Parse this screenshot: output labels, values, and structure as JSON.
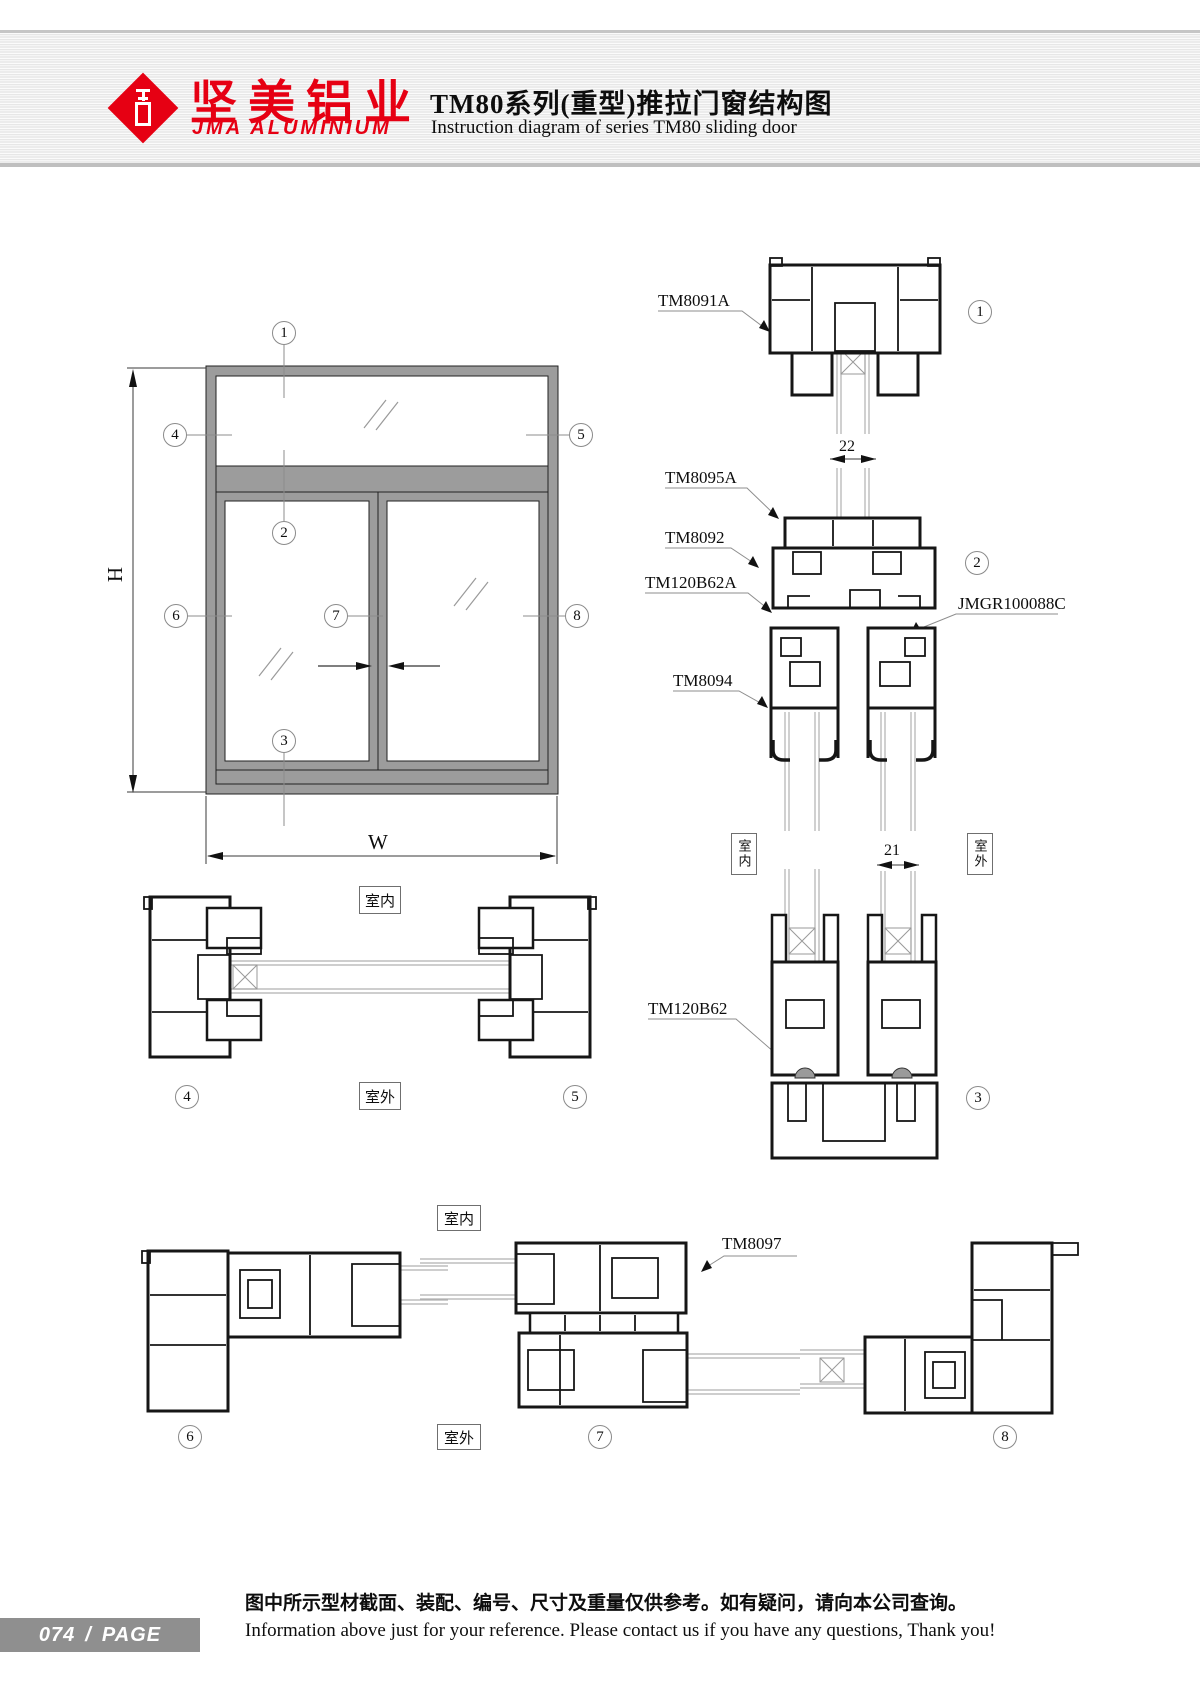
{
  "header": {
    "logo_cn": "坚美铝业",
    "logo_en": "JMA ALUMINIUM",
    "title_cn": "TM80系列(重型)推拉门窗结构图",
    "title_en": "Instruction diagram of series TM80 sliding door"
  },
  "labels": {
    "tm8091a": "TM8091A",
    "tm8095a": "TM8095A",
    "tm8092": "TM8092",
    "tm120b62a": "TM120B62A",
    "jmgr100088c": "JMGR100088C",
    "tm8094": "TM8094",
    "tm120b62": "TM120B62",
    "tm8097": "TM8097"
  },
  "dims": {
    "h": "H",
    "w": "W",
    "d22": "22",
    "d21": "21"
  },
  "rooms": {
    "indoor": "室内",
    "outdoor": "室外"
  },
  "circles": {
    "n1": "1",
    "n2": "2",
    "n3": "3",
    "n4": "4",
    "n5": "5",
    "n6": "6",
    "n7": "7",
    "n8": "8"
  },
  "footer": {
    "page_num": "074",
    "slash": "/",
    "page_word": "PAGE",
    "note_cn": "图中所示型材截面、装配、编号、尺寸及重量仅供参考。如有疑问，请向本公司查询。",
    "note_en": "Information above just for your reference. Please contact us if you have any questions, Thank you!"
  }
}
